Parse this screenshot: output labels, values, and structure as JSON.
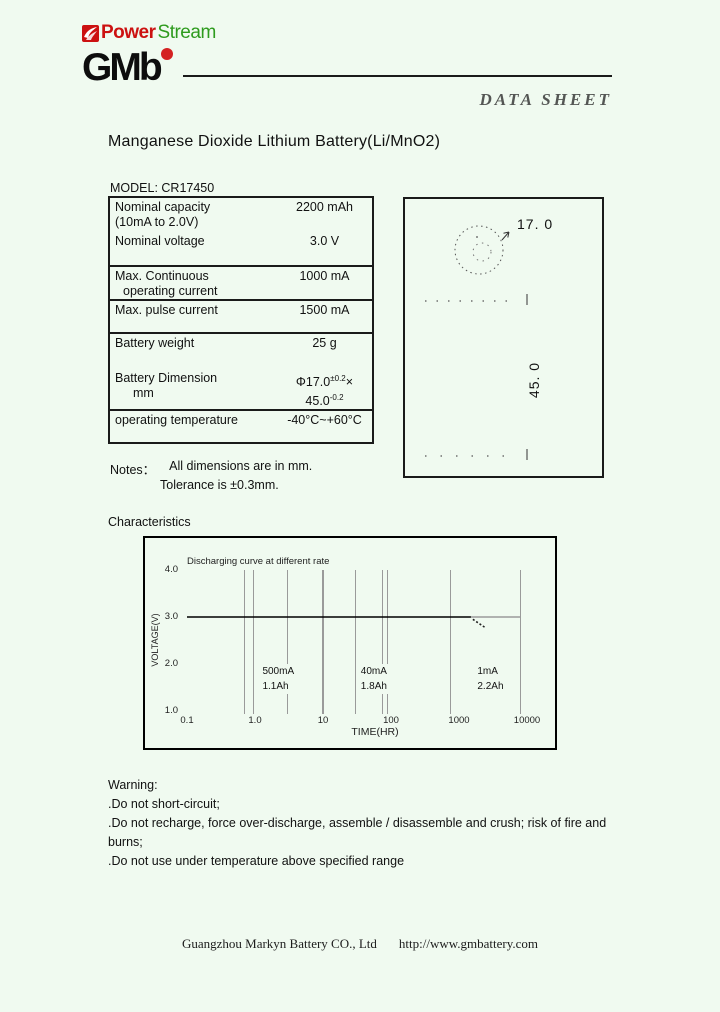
{
  "page": {
    "background": "#f0faf0"
  },
  "header": {
    "powerstream": {
      "power": "Power",
      "stream": "Stream",
      "power_color": "#cc1111",
      "stream_color": "#2e9b1e",
      "icon": "powerstream-swoosh-icon",
      "icon_color": "#cc1111"
    },
    "gmb_logo_text": "GMb",
    "gmb_dot_color": "#d42222",
    "datasheet_label": "DATA SHEET"
  },
  "title": "Manganese Dioxide Lithium Battery(Li/MnO2)",
  "model_label": "MODEL: CR17450",
  "spec_table": {
    "rows": [
      {
        "label": "Nominal capacity",
        "label2": "(10mA to 2.0V)",
        "value": "2200 mAh"
      },
      {
        "label": "Nominal voltage",
        "value": "3.0 V"
      },
      {
        "label": "Max. Continuous",
        "label2": "operating current",
        "value": "1000 mA"
      },
      {
        "label": "Max. pulse current",
        "value": "1500 mA"
      },
      {
        "label": "Battery weight",
        "value": "25 g"
      },
      {
        "label": "Battery Dimension",
        "label2": "mm",
        "value_parts": {
          "p1": "Φ17.0",
          "sup1": "±0.2",
          "p2": "×",
          "p3": "45.0",
          "sup2": "-0.2"
        }
      },
      {
        "label": "operating temperature",
        "value": "-40°C~+60°C"
      }
    ]
  },
  "diagram": {
    "diameter_label": "17. 0",
    "height_label": "45. 0"
  },
  "notes": {
    "heading": "Notes：",
    "line1": "All dimensions are in mm.",
    "line2": "Tolerance is ±0.3mm."
  },
  "characteristics_label": "Characteristics",
  "chart_data": {
    "type": "line",
    "title": "Discharging curve at different rate",
    "xlabel": "TIME(HR)",
    "ylabel": "VOLTAGE(V)",
    "x_scale": "log",
    "xlim": [
      0.1,
      10000
    ],
    "ylim": [
      1.0,
      4.0
    ],
    "grid": "vertical-only",
    "x_ticks": [
      {
        "label": "0.1",
        "t": 0.1
      },
      {
        "label": "1.0",
        "t": 1
      },
      {
        "label": "10",
        "t": 10
      },
      {
        "label": "100",
        "t": 100
      },
      {
        "label": "1000",
        "t": 1000
      },
      {
        "label": "10000",
        "t": 10000
      }
    ],
    "y_ticks": [
      {
        "label": "4.0",
        "v": 4
      },
      {
        "label": "3.0",
        "v": 3
      },
      {
        "label": "2.0",
        "v": 2
      },
      {
        "label": "1.0",
        "v": 1
      }
    ],
    "gridlines": [
      {
        "x": 0.7,
        "w": 1
      },
      {
        "x": 0.95,
        "w": 1
      },
      {
        "x": 3,
        "w": 1
      },
      {
        "x": 10,
        "w": 2
      },
      {
        "x": 30,
        "w": 1
      },
      {
        "x": 75,
        "w": 1
      },
      {
        "x": 88,
        "w": 1
      },
      {
        "x": 740,
        "w": 1
      },
      {
        "x": 7900,
        "w": 1
      }
    ],
    "series": [
      {
        "name": "500mA",
        "capacity_label": "1.1Ah",
        "plateau_voltage": 3.0,
        "end_time_hr": 2.2
      },
      {
        "name": "40mA",
        "capacity_label": "1.8Ah",
        "plateau_voltage": 3.0,
        "end_time_hr": 45
      },
      {
        "name": "1mA",
        "capacity_label": "2.2Ah",
        "plateau_voltage": 3.0,
        "end_time_hr": 2200
      }
    ],
    "segments": [
      {
        "style": "solid",
        "color": "#000000",
        "points": [
          [
            0.1,
            3.0
          ],
          [
            1500,
            3.0
          ]
        ]
      },
      {
        "style": "solid",
        "color": "#9a9a9a",
        "points": [
          [
            1500,
            3.0
          ],
          [
            7900,
            3.0
          ]
        ]
      },
      {
        "style": "dotted",
        "color": "#222222",
        "points": [
          [
            1600,
            2.95
          ],
          [
            2400,
            2.78
          ]
        ]
      }
    ],
    "annotations": [
      {
        "rate": "500mA",
        "capacity": "1.1Ah",
        "t": 2.2
      },
      {
        "rate": "40mA",
        "capacity": "1.8Ah",
        "t": 56
      },
      {
        "rate": "1mA",
        "capacity": "2.2Ah",
        "t": 2900
      }
    ]
  },
  "warning": {
    "heading": "Warning:",
    "items": [
      ".Do not short-circuit;",
      ".Do not recharge, force over-discharge, assemble / disassemble and crush; risk of fire and burns;",
      ".Do not use under temperature above specified range"
    ]
  },
  "footer": {
    "company": "Guangzhou Markyn Battery CO., Ltd",
    "url": "http://www.gmbattery.com"
  }
}
